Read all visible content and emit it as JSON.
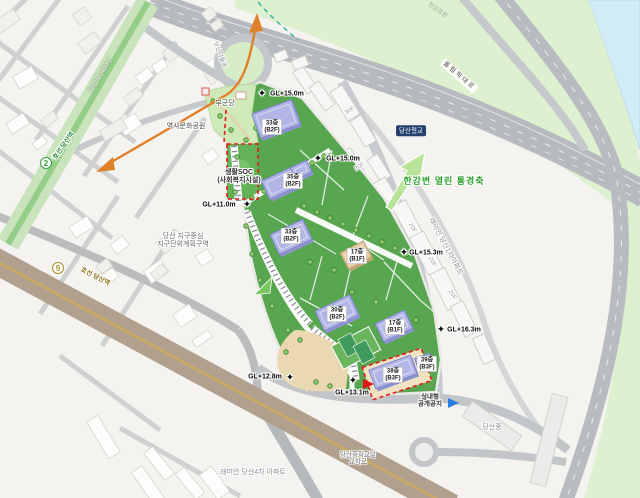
{
  "colors": {
    "site_green": "#58a750",
    "axis_green": "#2ea12e",
    "line2_green": "#2fa23c",
    "line9_gold": "#a98f2f",
    "orange_axis": "#e0802a",
    "red_dashed_boundary": "#e51a1a",
    "water_blue": "#d2ecf6",
    "building_purple": "#b1b6e7"
  },
  "map": {
    "subway_badges": [
      {
        "id": "line2-badge",
        "number": "2",
        "x": 46,
        "y": 163,
        "color": "#2fa23c"
      },
      {
        "id": "line9-badge",
        "number": "9",
        "x": 58,
        "y": 268,
        "color": "#a98f2f"
      }
    ],
    "labels": [
      {
        "id": "dangsan-ro-label",
        "text": "당산로(40m)",
        "x": 101,
        "y": 76,
        "rot": -59,
        "cls": "road-green"
      },
      {
        "id": "line2-station-label",
        "text": "호선 당산역",
        "x": 64,
        "y": 146,
        "rot": -55,
        "cls": "line2 halo"
      },
      {
        "id": "line9-station-label",
        "text": "호선 당산역",
        "x": 95,
        "y": 277,
        "rot": 27,
        "cls": "line9 halo"
      },
      {
        "id": "dangsan-nadeulmok-label",
        "text": "당산나들목",
        "x": 219,
        "y": 55,
        "rot": 70,
        "cls": "road-gray-sm halo"
      },
      {
        "id": "olympic-daero-label",
        "text": "올림픽대로",
        "x": 459,
        "y": 76,
        "rot": 41,
        "cls": "road-boxed"
      },
      {
        "id": "hangang-park-label",
        "text": "한강공원",
        "x": 437,
        "y": 11,
        "rot": 35,
        "cls": "park-faint"
      },
      {
        "id": "dangsan-railbridge-badge",
        "text": "당산철교",
        "x": 411,
        "y": 131,
        "rot": 0,
        "cls": "navy-badge"
      },
      {
        "id": "bugundang-label",
        "text": "부군당",
        "x": 225,
        "y": 104,
        "rot": 0,
        "cls": "place halo"
      },
      {
        "id": "history-culture-park-label",
        "text": "역사문화공원",
        "x": 186,
        "y": 127,
        "rot": 0,
        "cls": "place halo"
      },
      {
        "id": "saenghwal-soc-label",
        "text": "생활SOC\n(사회복지시설)",
        "x": 239,
        "y": 177,
        "rot": 0,
        "cls": "place-bold halo"
      },
      {
        "id": "district-plan-label",
        "text": "당산 지구중심\n지구단위계획구역",
        "x": 183,
        "y": 241,
        "rot": 0,
        "cls": "place-gray halo"
      },
      {
        "id": "hangang-view-axis-label",
        "text": "한강변 열린 통경축",
        "x": 444,
        "y": 181,
        "rot": 0,
        "cls": "green-axis halo"
      },
      {
        "id": "raemian-dangsan1-label",
        "text": "래미안 당산1차아파트",
        "x": 445,
        "y": 247,
        "rot": 62,
        "cls": "apt-gray halo"
      },
      {
        "id": "raemian-dangsan4-label",
        "text": "래미안 당산4차 아파트",
        "x": 253,
        "y": 473,
        "rot": 0,
        "cls": "apt-gray halo"
      },
      {
        "id": "dangsan-middle-crossroad-label",
        "text": "당산중학교앞\n교차로",
        "x": 358,
        "y": 459,
        "rot": 0,
        "cls": "place-gray-sm halo"
      },
      {
        "id": "dangsan-middle-school-label",
        "text": "당산중",
        "x": 492,
        "y": 428,
        "rot": 0,
        "cls": "apt-gray halo"
      },
      {
        "id": "indoor-public-space-label",
        "text": "실내형\n공개공지",
        "x": 430,
        "y": 401,
        "rot": 0,
        "cls": "place-bold-sm halo"
      }
    ],
    "gl_markers": [
      {
        "text": "GL+15.0m",
        "tx": 287,
        "ty": 94,
        "mx": 262,
        "my": 94
      },
      {
        "text": "GL+15.0m",
        "tx": 343,
        "ty": 159,
        "mx": 318,
        "my": 159
      },
      {
        "text": "GL+15.3m",
        "tx": 426,
        "ty": 253,
        "mx": 404,
        "my": 253
      },
      {
        "text": "GL+16.3m",
        "tx": 464,
        "ty": 330,
        "mx": 441,
        "my": 330
      },
      {
        "text": "GL+11.0m",
        "tx": 219,
        "ty": 205,
        "mx": 247,
        "my": 205
      },
      {
        "text": "GL+12.8m",
        "tx": 265,
        "ty": 377,
        "mx": 290,
        "my": 378
      },
      {
        "text": "GL+13.1m",
        "tx": 352,
        "ty": 393,
        "mx": 353,
        "my": 381
      }
    ],
    "site_building_labels": [
      {
        "floors": "33층",
        "basement": "(B2F)",
        "x": 272,
        "y": 127
      },
      {
        "floors": "35층",
        "basement": "(B2F)",
        "x": 293,
        "y": 181
      },
      {
        "floors": "33층",
        "basement": "(B2F)",
        "x": 291,
        "y": 236
      },
      {
        "floors": "17층",
        "basement": "(B1F)",
        "x": 357,
        "y": 256
      },
      {
        "floors": "30층",
        "basement": "(B2F)",
        "x": 337,
        "y": 314
      },
      {
        "floors": "17층",
        "basement": "(B1F)",
        "x": 395,
        "y": 327
      },
      {
        "floors": "38층",
        "basement": "(B3F)",
        "x": 393,
        "y": 375
      },
      {
        "floors": "39층",
        "basement": "(B3F)",
        "x": 427,
        "y": 364
      }
    ],
    "floor_tags": [
      {
        "text": "30F",
        "x": 350,
        "y": 111,
        "rot": -32
      },
      {
        "text": "20F",
        "x": 360,
        "y": 167,
        "rot": -32
      },
      {
        "text": "20F",
        "x": 412,
        "y": 228,
        "rot": 60
      },
      {
        "text": "20F",
        "x": 432,
        "y": 262,
        "rot": 60
      },
      {
        "text": "20F",
        "x": 452,
        "y": 295,
        "rot": 60
      }
    ]
  }
}
